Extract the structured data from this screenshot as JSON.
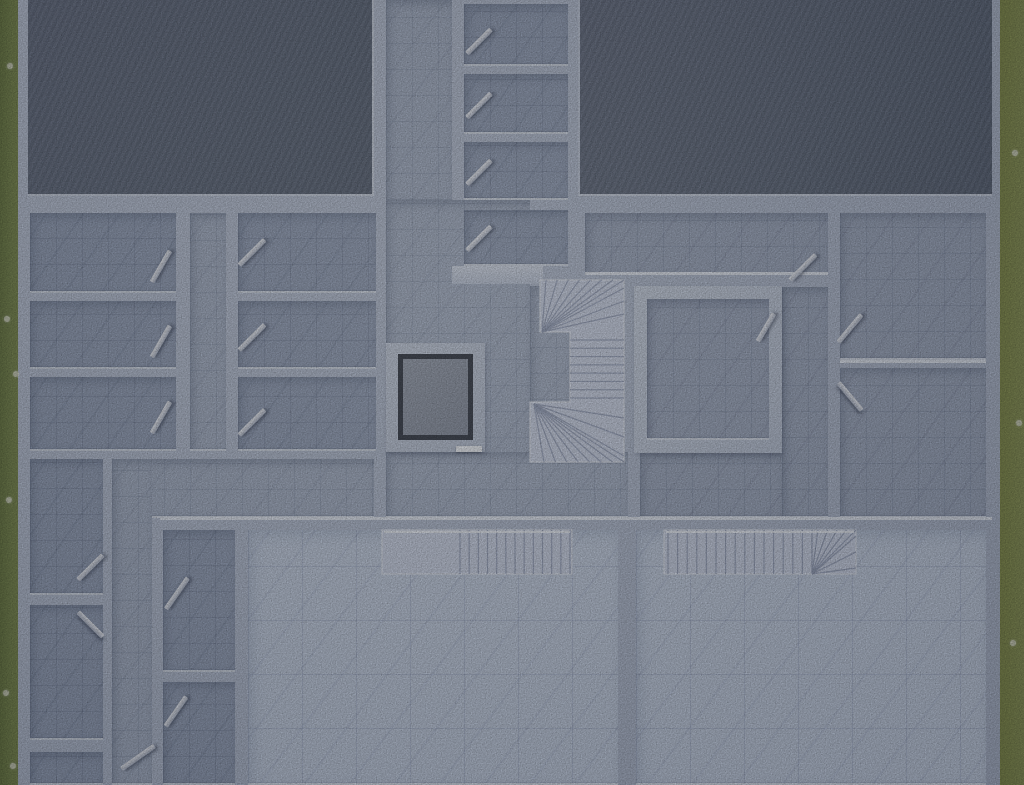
{
  "scene": {
    "kind": "floor-plan-top-down-render",
    "width": 1024,
    "height": 785
  },
  "palette": {
    "grass_left": "#7a8950",
    "grass_right": "#8a9355",
    "wall": "#bcc6d8",
    "wall_cap": "#e3e9f3",
    "slab_dark": "#667082",
    "floor_hall": "#a9b4c8",
    "floor_room": "#98a4bb",
    "floor_room_right": "#a1acc1",
    "floor_bright": "#c5d0e2",
    "stair_marble": "#cdd5e7",
    "elevator_pit": "#3d434f",
    "elevator_car": "#939baa",
    "door_leaf": "#dfe4ee"
  },
  "grass": [
    {
      "name": "grass-strip-left",
      "cls": "grass-l",
      "r": [
        0,
        0,
        18,
        785
      ]
    },
    {
      "name": "grass-strip-right",
      "cls": "grass-r",
      "r": [
        1000,
        0,
        24,
        785
      ]
    }
  ],
  "pebbles": [
    [
      7,
      63
    ],
    [
      4,
      316
    ],
    [
      13,
      371
    ],
    [
      6,
      497
    ],
    [
      10,
      763
    ],
    [
      3,
      690
    ],
    [
      1012,
      150
    ],
    [
      1016,
      420
    ],
    [
      1010,
      640
    ]
  ],
  "base": {
    "name": "building-slab-walls",
    "r": [
      16,
      0,
      988,
      785
    ]
  },
  "slabs": [
    {
      "name": "roof-slab-left",
      "cls": "slab left",
      "r": [
        28,
        0,
        346,
        196
      ]
    },
    {
      "name": "roof-slab-right",
      "cls": "slab right",
      "r": [
        578,
        0,
        414,
        196
      ]
    }
  ],
  "floors": [
    {
      "name": "corridor-north",
      "cls": "f-hall",
      "r": [
        386,
        0,
        66,
        202
      ]
    },
    {
      "name": "hall-main",
      "cls": "f-hall",
      "r": [
        386,
        200,
        144,
        318
      ]
    },
    {
      "name": "hall-stair-notch",
      "cls": "f-hall",
      "r": [
        530,
        286,
        40,
        168
      ]
    },
    {
      "name": "hall-south",
      "cls": "f-hall",
      "r": [
        386,
        452,
        242,
        66
      ]
    },
    {
      "name": "storage-room-1",
      "cls": "f-room",
      "r": [
        464,
        4,
        104,
        62
      ]
    },
    {
      "name": "storage-room-2",
      "cls": "f-room",
      "r": [
        464,
        74,
        104,
        60
      ]
    },
    {
      "name": "storage-room-3",
      "cls": "f-room",
      "r": [
        464,
        142,
        104,
        58
      ]
    },
    {
      "name": "storage-room-4",
      "cls": "f-room",
      "r": [
        464,
        210,
        104,
        56
      ]
    },
    {
      "name": "room-west-a1",
      "cls": "f-room",
      "r": [
        30,
        213,
        146,
        80
      ]
    },
    {
      "name": "room-west-a2",
      "cls": "f-room",
      "r": [
        30,
        301,
        146,
        68
      ]
    },
    {
      "name": "room-west-a3",
      "cls": "f-room",
      "r": [
        30,
        377,
        146,
        74
      ]
    },
    {
      "name": "corridor-west",
      "cls": "f-hall",
      "r": [
        190,
        213,
        36,
        238
      ]
    },
    {
      "name": "room-west-b1",
      "cls": "f-room",
      "r": [
        238,
        213,
        138,
        80
      ]
    },
    {
      "name": "room-west-b2",
      "cls": "f-room",
      "r": [
        238,
        301,
        138,
        68
      ]
    },
    {
      "name": "room-west-b3",
      "cls": "f-room",
      "r": [
        238,
        377,
        138,
        74
      ]
    },
    {
      "name": "hall-west-band",
      "cls": "f-hall",
      "r": [
        112,
        459,
        262,
        59
      ]
    },
    {
      "name": "corridor-southwest",
      "cls": "f-hall",
      "r": [
        112,
        459,
        40,
        326
      ]
    },
    {
      "name": "room-east-top",
      "cls": "f-roomr",
      "r": [
        585,
        213,
        243,
        62
      ]
    },
    {
      "name": "room-east-b",
      "cls": "f-roomr",
      "r": [
        840,
        213,
        146,
        147
      ]
    },
    {
      "name": "room-east-c",
      "cls": "f-roomr",
      "r": [
        840,
        368,
        146,
        150
      ]
    },
    {
      "name": "corridor-east",
      "cls": "f-roomr",
      "r": [
        782,
        287,
        46,
        231
      ]
    },
    {
      "name": "hall-east-south",
      "cls": "f-roomr",
      "r": [
        640,
        453,
        142,
        65
      ]
    },
    {
      "name": "room-sw-l1",
      "cls": "f-room",
      "r": [
        30,
        459,
        73,
        136
      ]
    },
    {
      "name": "room-sw-l2",
      "cls": "f-room",
      "r": [
        30,
        605,
        73,
        135
      ]
    },
    {
      "name": "room-sw-l3",
      "cls": "f-room",
      "r": [
        30,
        752,
        73,
        33
      ]
    },
    {
      "name": "room-small-1",
      "cls": "f-room",
      "r": [
        163,
        530,
        72,
        142
      ]
    },
    {
      "name": "room-small-2",
      "cls": "f-room",
      "r": [
        163,
        682,
        72,
        103
      ]
    },
    {
      "name": "living-room-left",
      "cls": "f-bright",
      "r": [
        248,
        530,
        370,
        255
      ]
    },
    {
      "name": "living-room-right",
      "cls": "f-bright",
      "r": [
        636,
        530,
        350,
        255
      ]
    }
  ],
  "room_d": {
    "name": "room-center-east",
    "outer": [
      634,
      286,
      148,
      167
    ],
    "wall": 13,
    "floor_cls": "f-roomr"
  },
  "walls_extra": [
    {
      "name": "stair-top-wall",
      "r": [
        452,
        266,
        91,
        18
      ]
    }
  ],
  "caps": [
    {
      "name": "long-wall-cap",
      "r": [
        160,
        517,
        832,
        3
      ]
    },
    {
      "name": "east-wall-cap",
      "r": [
        585,
        272,
        243,
        3
      ]
    },
    {
      "name": "room-b-wall-cap",
      "r": [
        840,
        360,
        146,
        3
      ]
    }
  ],
  "elevator": {
    "name": "elevator-shaft",
    "r": [
      386,
      343,
      99,
      109
    ],
    "ring": [
      12,
      11,
      75,
      86
    ],
    "car": [
      17,
      16,
      65,
      76
    ],
    "sill": [
      70,
      103,
      26,
      6
    ]
  },
  "stairs": [
    {
      "name": "stair-main-winder",
      "x": 530,
      "y": 266,
      "w": 110,
      "h": 206,
      "poly": "10,14 94,14 94,196 0,196 0,136 40,136 40,66 10,66",
      "treads": [
        {
          "type": "fan",
          "pivot": [
            12,
            66
          ],
          "from": [
            16,
            14
          ],
          "to": [
            94,
            14
          ],
          "n": 8
        },
        {
          "type": "fan",
          "pivot": [
            12,
            66
          ],
          "from": [
            94,
            22
          ],
          "to": [
            94,
            48
          ],
          "n": 3
        },
        {
          "type": "hlines",
          "x0": 40,
          "x1": 94,
          "y0": 74,
          "y1": 132,
          "n": 8
        },
        {
          "type": "fan",
          "pivot": [
            4,
            138
          ],
          "from": [
            14,
            196
          ],
          "to": [
            94,
            196
          ],
          "n": 8
        },
        {
          "type": "fan",
          "pivot": [
            4,
            138
          ],
          "from": [
            94,
            152
          ],
          "to": [
            94,
            190
          ],
          "n": 3
        }
      ]
    },
    {
      "name": "stair-unit-left",
      "x": 382,
      "y": 528,
      "w": 190,
      "h": 48,
      "rect": [
        0,
        2,
        190,
        44
      ],
      "treads": [
        {
          "type": "vlines",
          "x0": 78,
          "x1": 188,
          "y0": 2,
          "y1": 46,
          "n": 13
        },
        {
          "type": "hline-bright",
          "x0": 2,
          "x1": 188,
          "y": 4
        }
      ]
    },
    {
      "name": "stair-unit-right",
      "x": 664,
      "y": 528,
      "w": 192,
      "h": 46,
      "rect": [
        0,
        2,
        192,
        44
      ],
      "treads": [
        {
          "type": "vlines",
          "x0": 4,
          "x1": 148,
          "y0": 2,
          "y1": 46,
          "n": 16
        },
        {
          "type": "fan",
          "pivot": [
            148,
            46
          ],
          "from": [
            154,
            2
          ],
          "to": [
            192,
            2
          ],
          "n": 5
        },
        {
          "type": "fan",
          "pivot": [
            148,
            46
          ],
          "from": [
            192,
            8
          ],
          "to": [
            192,
            40
          ],
          "n": 3
        },
        {
          "type": "hline-bright",
          "x0": 2,
          "x1": 190,
          "y": 4
        }
      ]
    }
  ],
  "doors": [
    {
      "name": "door-storage-1",
      "c": [
        479,
        41
      ],
      "len": 34,
      "rot": -45
    },
    {
      "name": "door-storage-2",
      "c": [
        479,
        105
      ],
      "len": 34,
      "rot": -45
    },
    {
      "name": "door-storage-3",
      "c": [
        479,
        172
      ],
      "len": 34,
      "rot": -45
    },
    {
      "name": "door-storage-4",
      "c": [
        479,
        238
      ],
      "len": 34,
      "rot": -45
    },
    {
      "name": "door-room-a1",
      "c": [
        161,
        266
      ],
      "len": 36,
      "rot": -60
    },
    {
      "name": "door-room-a2",
      "c": [
        161,
        341
      ],
      "len": 36,
      "rot": -60
    },
    {
      "name": "door-room-a3",
      "c": [
        161,
        417
      ],
      "len": 36,
      "rot": -60
    },
    {
      "name": "door-room-b1",
      "c": [
        252,
        252
      ],
      "len": 36,
      "rot": -45
    },
    {
      "name": "door-room-b2",
      "c": [
        252,
        337
      ],
      "len": 36,
      "rot": -45
    },
    {
      "name": "door-room-b3",
      "c": [
        252,
        422
      ],
      "len": 36,
      "rot": -45
    },
    {
      "name": "door-room-east-top",
      "c": [
        803,
        267
      ],
      "len": 36,
      "rot": -45
    },
    {
      "name": "door-room-east-b",
      "c": [
        850,
        328
      ],
      "len": 36,
      "rot": -50
    },
    {
      "name": "door-room-east-c",
      "c": [
        850,
        396
      ],
      "len": 36,
      "rot": 50
    },
    {
      "name": "door-room-center",
      "c": [
        766,
        327
      ],
      "len": 32,
      "rot": -60
    },
    {
      "name": "door-room-sw-l1",
      "c": [
        90,
        567
      ],
      "len": 35,
      "rot": -45
    },
    {
      "name": "door-room-sw-l2",
      "c": [
        90,
        624
      ],
      "len": 35,
      "rot": 45
    },
    {
      "name": "door-room-small-1",
      "c": [
        177,
        593
      ],
      "len": 38,
      "rot": -55
    },
    {
      "name": "door-room-small-2",
      "c": [
        176,
        711
      ],
      "len": 36,
      "rot": -55
    },
    {
      "name": "door-corridor-sw",
      "c": [
        138,
        757
      ],
      "len": 40,
      "rot": -35
    }
  ]
}
